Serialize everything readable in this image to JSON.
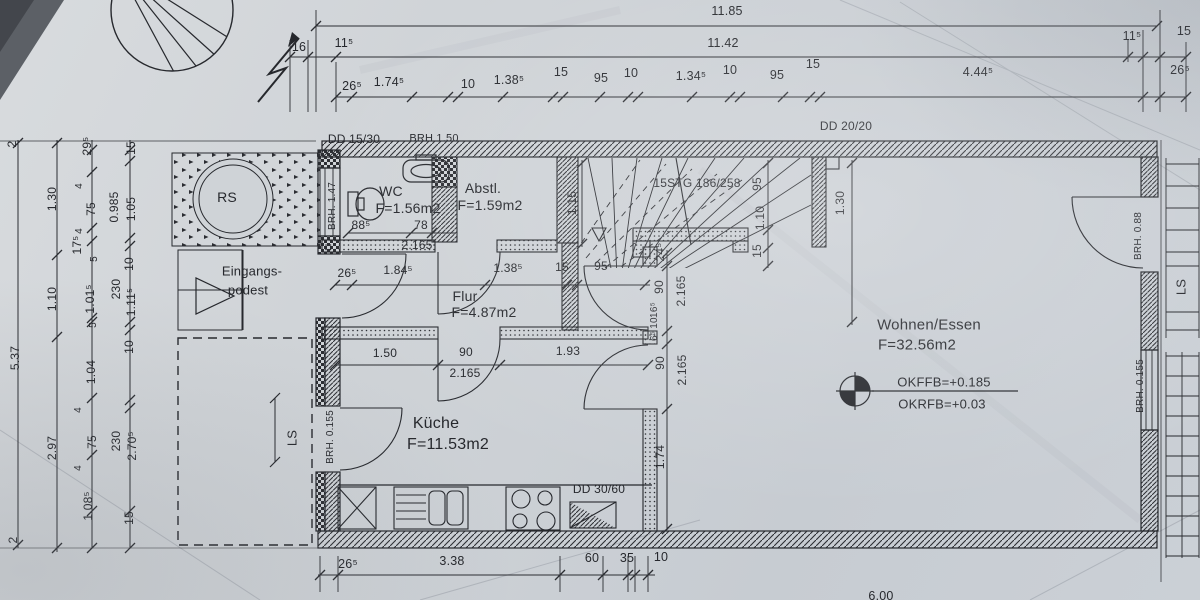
{
  "colors": {
    "paper": "#cdd1d6",
    "ink": "#26282d",
    "photo_corner": "#5c6066"
  },
  "labels": {
    "top_dims": [
      {
        "t": "11.85",
        "x": 727,
        "y": 11
      },
      {
        "t": "11.42",
        "x": 723,
        "y": 43
      },
      {
        "t": "16",
        "x": 299,
        "y": 47
      },
      {
        "t": "11⁵",
        "x": 344,
        "y": 43
      },
      {
        "t": "11⁵",
        "x": 1132,
        "y": 36
      },
      {
        "t": "15",
        "x": 1184,
        "y": 31
      },
      {
        "t": "26⁵",
        "x": 352,
        "y": 86
      },
      {
        "t": "1.74⁵",
        "x": 389,
        "y": 82
      },
      {
        "t": "10",
        "x": 468,
        "y": 84
      },
      {
        "t": "1.38⁵",
        "x": 509,
        "y": 80
      },
      {
        "t": "15",
        "x": 561,
        "y": 72
      },
      {
        "t": "95",
        "x": 601,
        "y": 78
      },
      {
        "t": "10",
        "x": 631,
        "y": 73
      },
      {
        "t": "1.34⁵",
        "x": 691,
        "y": 76
      },
      {
        "t": "10",
        "x": 730,
        "y": 70
      },
      {
        "t": "95",
        "x": 777,
        "y": 75
      },
      {
        "t": "15",
        "x": 813,
        "y": 64
      },
      {
        "t": "4.44⁵",
        "x": 978,
        "y": 72
      },
      {
        "t": "26⁵",
        "x": 1180,
        "y": 70
      }
    ],
    "left_dims": [
      {
        "t": "2",
        "x": 12,
        "y": 144,
        "r": -90
      },
      {
        "t": "5.37",
        "x": 15,
        "y": 358,
        "r": -90
      },
      {
        "t": "2",
        "x": 13,
        "y": 540,
        "r": -90
      },
      {
        "t": "1.30",
        "x": 52,
        "y": 199,
        "r": -90
      },
      {
        "t": "1.10",
        "x": 52,
        "y": 299,
        "r": -90
      },
      {
        "t": "2.97",
        "x": 52,
        "y": 448,
        "r": -90
      },
      {
        "t": "29⁵",
        "x": 87,
        "y": 146,
        "r": -90
      },
      {
        "t": "4",
        "x": 80,
        "y": 186,
        "r": -90,
        "s": 10
      },
      {
        "t": "75",
        "x": 91,
        "y": 209,
        "r": -90
      },
      {
        "t": "4",
        "x": 80,
        "y": 231,
        "r": -90,
        "s": 10
      },
      {
        "t": "17⁵",
        "x": 77,
        "y": 245,
        "r": -90
      },
      {
        "t": "5",
        "x": 95,
        "y": 259,
        "r": -90,
        "s": 10
      },
      {
        "t": "1.01⁵",
        "x": 90,
        "y": 299,
        "r": -90
      },
      {
        "t": "5",
        "x": 94,
        "y": 325,
        "r": -90,
        "s": 10
      },
      {
        "t": "1.04",
        "x": 91,
        "y": 372,
        "r": -90
      },
      {
        "t": "4",
        "x": 79,
        "y": 410,
        "r": -90,
        "s": 10
      },
      {
        "t": "75",
        "x": 92,
        "y": 442,
        "r": -90
      },
      {
        "t": "4",
        "x": 79,
        "y": 468,
        "r": -90,
        "s": 10
      },
      {
        "t": "1.08⁵",
        "x": 88,
        "y": 506,
        "r": -90
      },
      {
        "t": "0.985",
        "x": 114,
        "y": 207,
        "r": -90
      },
      {
        "t": "230",
        "x": 116,
        "y": 289,
        "r": -90
      },
      {
        "t": "230",
        "x": 116,
        "y": 441,
        "r": -90
      },
      {
        "t": "15",
        "x": 131,
        "y": 148,
        "r": -90
      },
      {
        "t": "1.05",
        "x": 131,
        "y": 209,
        "r": -90
      },
      {
        "t": "10",
        "x": 129,
        "y": 264,
        "r": -90
      },
      {
        "t": "1.11⁵",
        "x": 131,
        "y": 302,
        "r": -90
      },
      {
        "t": "10",
        "x": 129,
        "y": 347,
        "r": -90
      },
      {
        "t": "2.70⁵",
        "x": 132,
        "y": 446,
        "r": -90
      },
      {
        "t": "15",
        "x": 129,
        "y": 518,
        "r": -90
      }
    ],
    "bottom_dims": [
      {
        "t": "26⁵",
        "x": 348,
        "y": 564
      },
      {
        "t": "3.38",
        "x": 452,
        "y": 561
      },
      {
        "t": "60",
        "x": 592,
        "y": 558
      },
      {
        "t": "35",
        "x": 627,
        "y": 558
      },
      {
        "t": "10",
        "x": 661,
        "y": 557
      },
      {
        "t": "6.00",
        "x": 881,
        "y": 596
      }
    ],
    "interior_dims": [
      {
        "t": "88⁵",
        "x": 361,
        "y": 225
      },
      {
        "t": "78",
        "x": 421,
        "y": 225
      },
      {
        "t": "2.165",
        "x": 417,
        "y": 245
      },
      {
        "t": "26⁵",
        "x": 347,
        "y": 273
      },
      {
        "t": "1.84⁵",
        "x": 398,
        "y": 270
      },
      {
        "t": "1.38⁵",
        "x": 508,
        "y": 268
      },
      {
        "t": "15",
        "x": 562,
        "y": 267
      },
      {
        "t": "95",
        "x": 601,
        "y": 266
      },
      {
        "t": "1.50",
        "x": 385,
        "y": 353
      },
      {
        "t": "90",
        "x": 466,
        "y": 352
      },
      {
        "t": "1.93",
        "x": 568,
        "y": 351
      },
      {
        "t": "2.165",
        "x": 465,
        "y": 373
      },
      {
        "t": "1.15",
        "x": 572,
        "y": 203,
        "r": -90
      },
      {
        "t": "95",
        "x": 757,
        "y": 184,
        "r": -90
      },
      {
        "t": "1.10",
        "x": 760,
        "y": 218,
        "r": -90
      },
      {
        "t": "15",
        "x": 757,
        "y": 251,
        "r": -90
      },
      {
        "t": "1.30",
        "x": 840,
        "y": 203,
        "r": -90
      },
      {
        "t": "24⁵",
        "x": 660,
        "y": 252,
        "r": -90
      },
      {
        "t": "90",
        "x": 659,
        "y": 287,
        "r": -90
      },
      {
        "t": "2.165",
        "x": 681,
        "y": 291,
        "r": -90
      },
      {
        "t": "16⁵",
        "x": 655,
        "y": 310,
        "r": -90,
        "s": 10
      },
      {
        "t": "10",
        "x": 655,
        "y": 323,
        "r": -90,
        "s": 10
      },
      {
        "t": "6⁵",
        "x": 655,
        "y": 336,
        "r": -90,
        "s": 10
      },
      {
        "t": "90",
        "x": 660,
        "y": 363,
        "r": -90
      },
      {
        "t": "2.165",
        "x": 682,
        "y": 370,
        "r": -90
      },
      {
        "t": "1.74",
        "x": 660,
        "y": 457,
        "r": -90
      }
    ],
    "rooms": [
      {
        "t": "WC",
        "x": 391,
        "y": 191,
        "n": "room-label-wc"
      },
      {
        "t": "F=1.56m2",
        "x": 408,
        "y": 208,
        "n": "room-area-wc"
      },
      {
        "t": "Abstl.",
        "x": 483,
        "y": 188,
        "n": "room-label-abstellraum"
      },
      {
        "t": "F=1.59m2",
        "x": 490,
        "y": 205,
        "n": "room-area-abstellraum"
      },
      {
        "t": "Flur",
        "x": 465,
        "y": 296,
        "n": "room-label-flur"
      },
      {
        "t": "F=4.87m2",
        "x": 484,
        "y": 312,
        "n": "room-area-flur"
      },
      {
        "t": "Küche",
        "x": 436,
        "y": 424,
        "s": 16,
        "n": "room-label-kueche"
      },
      {
        "t": "F=11.53m2",
        "x": 448,
        "y": 445,
        "s": 16,
        "n": "room-area-kueche"
      },
      {
        "t": "Wohnen/Essen",
        "x": 929,
        "y": 325,
        "s": 15,
        "n": "room-label-wohnen-essen"
      },
      {
        "t": "F=32.56m2",
        "x": 917,
        "y": 345,
        "s": 15,
        "n": "room-area-wohnen-essen"
      },
      {
        "t": "Eingangs-",
        "x": 252,
        "y": 271,
        "s": 13,
        "n": "label-eingangspodest"
      },
      {
        "t": "podest",
        "x": 248,
        "y": 290,
        "s": 13,
        "n": "label-eingangspodest"
      },
      {
        "t": "RS",
        "x": 227,
        "y": 197,
        "s": 14,
        "n": "label-rs"
      },
      {
        "t": "LS",
        "x": 292,
        "y": 438,
        "s": 13,
        "r": -90,
        "n": "label-ls"
      },
      {
        "t": "LS",
        "x": 1181,
        "y": 287,
        "s": 13,
        "r": -90,
        "n": "label-ls"
      }
    ],
    "annotations": [
      {
        "t": "DD 15/30",
        "x": 354,
        "y": 139
      },
      {
        "t": "BRH 1.50",
        "x": 434,
        "y": 139,
        "s": 11
      },
      {
        "t": "DD 20/20",
        "x": 846,
        "y": 126
      },
      {
        "t": "15STG 186/258",
        "x": 697,
        "y": 183,
        "n": "label-stairs"
      },
      {
        "t": "DD 30/60",
        "x": 599,
        "y": 489
      },
      {
        "t": "OKFFB=+0.185",
        "x": 944,
        "y": 382,
        "s": 13,
        "n": "label-okffb"
      },
      {
        "t": "OKRFB=+0.03",
        "x": 942,
        "y": 404,
        "s": 13,
        "n": "label-okrfb"
      },
      {
        "t": "BRH. 1.47",
        "x": 333,
        "y": 206,
        "s": 10,
        "r": -90
      },
      {
        "t": "BRH. 0.155",
        "x": 331,
        "y": 437,
        "s": 10,
        "r": -90
      },
      {
        "t": "BRH. 0.88",
        "x": 1139,
        "y": 236,
        "s": 10,
        "r": -90
      },
      {
        "t": "BRH. 0.155",
        "x": 1141,
        "y": 386,
        "s": 10,
        "r": -90
      }
    ]
  }
}
